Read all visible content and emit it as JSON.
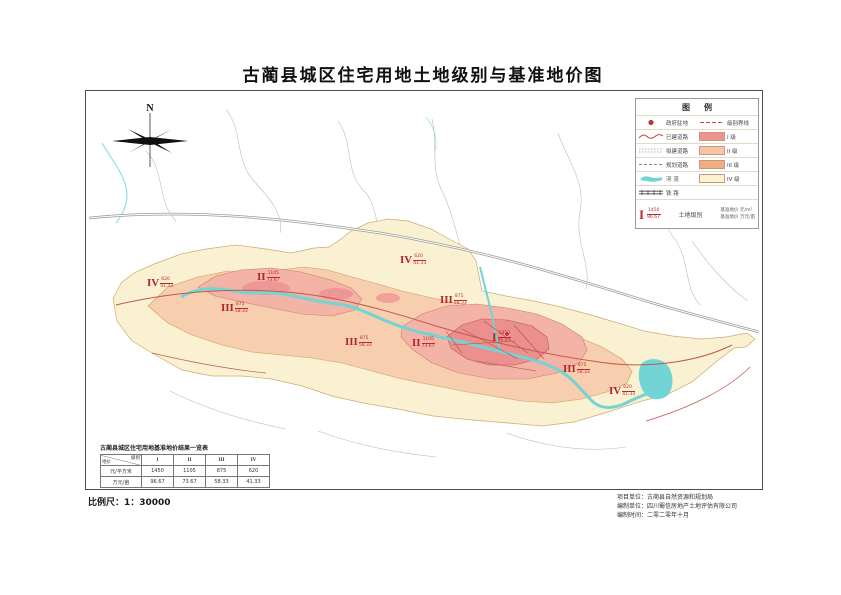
{
  "title": "古蔺县城区住宅用地土地级别与基准地价图",
  "compass": {
    "north_label": "N"
  },
  "legend": {
    "title": "图例",
    "rows": [
      {
        "left_symbol": "government-seat-dot",
        "left_label": "政府驻地",
        "right_symbol": "grade-boundary-dash",
        "right_label": "级别界线"
      },
      {
        "left_symbol": "built-road-line",
        "left_label": "已建道路",
        "right_symbol": "swatch:grade1",
        "right_label": "I 级"
      },
      {
        "left_symbol": "planned-road-line",
        "left_label": "拟建道路",
        "right_symbol": "swatch:grade2",
        "right_label": "II 级"
      },
      {
        "left_symbol": "plan-road-line",
        "left_label": "规划道路",
        "right_symbol": "swatch:grade3",
        "right_label": "III 级"
      },
      {
        "left_symbol": "river-symbol",
        "left_label": "河  流",
        "right_symbol": "swatch:grade4",
        "right_label": "IV 级"
      },
      {
        "left_symbol": "railway-symbol",
        "left_label": "铁  路",
        "right_symbol": "",
        "right_label": ""
      }
    ],
    "swatch_colors": {
      "grade1": "#ee938b",
      "grade2": "#f6c5a2",
      "grade3": "#f2ad80",
      "grade4": "#fbf2d0"
    },
    "key": {
      "sample_grade": "I",
      "sample_price_sqm": "1450",
      "sample_price_mu": "96.67",
      "center_label": "土地级别",
      "unit_line1": "基准地价 元/m²",
      "unit_line2": "基准地价 万元/亩"
    }
  },
  "map": {
    "colors": {
      "grade1": "#ec8f8f",
      "grade2": "#f3b3a6",
      "grade3": "#f7cfae",
      "grade4": "#faf1d3",
      "river": "#72d4d4",
      "road": "#c05a4a",
      "highway": "#9a9a9a",
      "boundary": "#c3bca6",
      "marker_red": "#c0262c"
    },
    "markers": [
      {
        "grade": "IV",
        "price_sqm": "620",
        "price_mu": "41.33",
        "x": 67,
        "y": 193
      },
      {
        "grade": "II",
        "price_sqm": "1105",
        "price_mu": "73.67",
        "x": 177,
        "y": 187
      },
      {
        "grade": "III",
        "price_sqm": "875",
        "price_mu": "58.33",
        "x": 141,
        "y": 218
      },
      {
        "grade": "III",
        "price_sqm": "875",
        "price_mu": "58.33",
        "x": 265,
        "y": 252
      },
      {
        "grade": "IV",
        "price_sqm": "620",
        "price_mu": "41.33",
        "x": 320,
        "y": 170
      },
      {
        "grade": "III",
        "price_sqm": "875",
        "price_mu": "58.33",
        "x": 360,
        "y": 210
      },
      {
        "grade": "II",
        "price_sqm": "1105",
        "price_mu": "73.67",
        "x": 332,
        "y": 253
      },
      {
        "grade": "I",
        "price_sqm": "1450",
        "price_mu": "96.67",
        "x": 412,
        "y": 247
      },
      {
        "grade": "III",
        "price_sqm": "875",
        "price_mu": "58.33",
        "x": 483,
        "y": 279
      },
      {
        "grade": "IV",
        "price_sqm": "620",
        "price_mu": "41.33",
        "x": 529,
        "y": 301
      }
    ]
  },
  "table": {
    "title": "古蔺县城区住宅用地基准地价结果一览表",
    "corner_top": "级别",
    "corner_bottom": "地价",
    "columns": [
      "I",
      "II",
      "III",
      "IV"
    ],
    "rows": [
      {
        "label": "元/平方米",
        "values": [
          "1450",
          "1105",
          "875",
          "620"
        ]
      },
      {
        "label": "万元/亩",
        "values": [
          "96.67",
          "73.67",
          "58.33",
          "41.33"
        ]
      }
    ]
  },
  "scale": {
    "label": "比例尺：1：30000"
  },
  "credits": {
    "line1": "项目单位：古蔺县自然资源和规划局",
    "line2": "编制单位：四川蜀信房地产土地评估有限公司",
    "line3": "编制时间：二零二零年十月"
  }
}
